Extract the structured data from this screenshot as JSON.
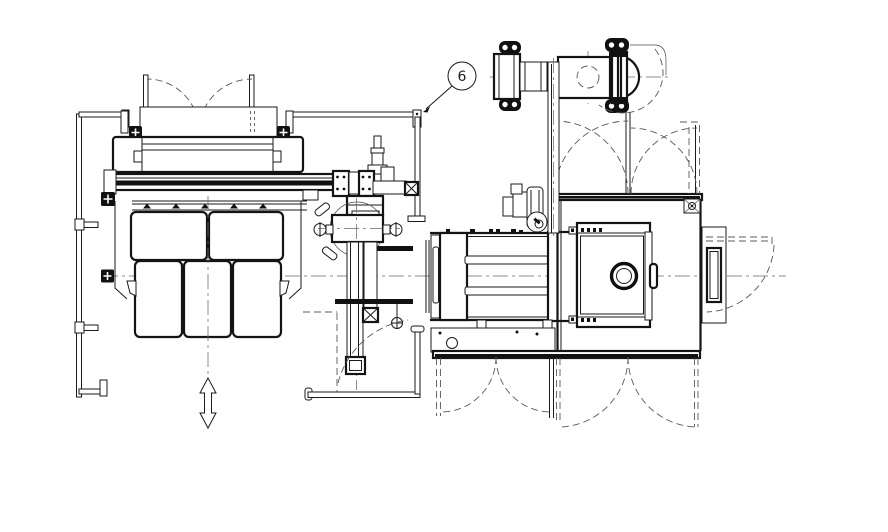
{
  "meta": {
    "kind": "engineering plan-view machine layout drawing",
    "background": "#ffffff"
  },
  "colors": {
    "line": "#1a1a1a",
    "dashed": "#585858",
    "centerline": "#6a6a6a",
    "fill": "#ffffff"
  },
  "callouts": {
    "balloon_6": {
      "label": "6"
    }
  },
  "components": [
    "left-guard-fence",
    "top-guard-fence",
    "bottom-guard-fence",
    "infeed-hood-doors",
    "infeed-machine-frame",
    "carriage-rail",
    "panel-cabinet-row-upper",
    "panel-cabinet-row-lower",
    "travel-direction-arrow",
    "transfer-carriage",
    "rotary-clamp-head",
    "vertical-transfer-arm",
    "arm-swing-arc",
    "central-machine-bed",
    "base-plate",
    "lower-door-swings",
    "right-machine-housing",
    "inspection-porthole",
    "side-door-panel",
    "door-open-swing",
    "upper-door-swings",
    "motor-gearbox-unit",
    "pump-unit",
    "support-column"
  ]
}
